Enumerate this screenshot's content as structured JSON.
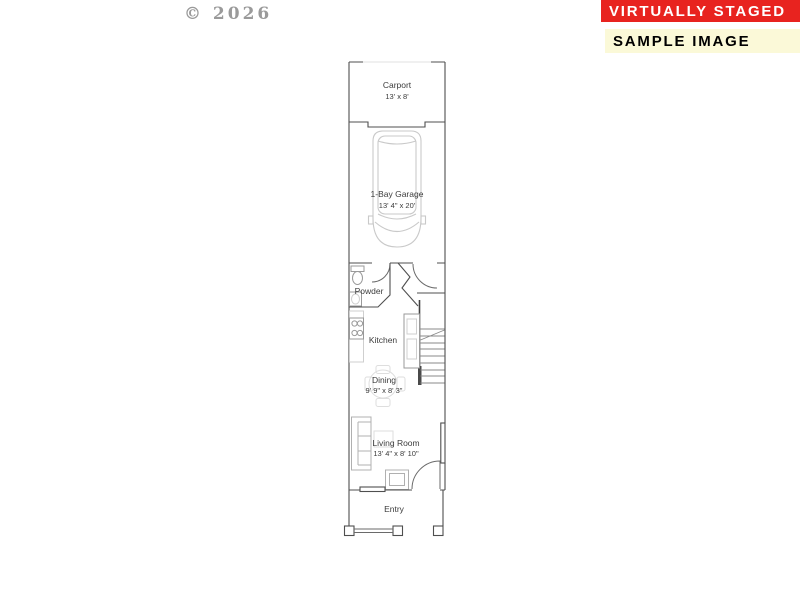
{
  "copyright": "© 2026",
  "badges": {
    "virtually_staged": {
      "label": "VIRTUALLY STAGED",
      "bg": "#e8231f",
      "fg": "#ffffff"
    },
    "sample_image": {
      "label": "SAMPLE IMAGE",
      "bg": "#fbf9d8",
      "fg": "#000000"
    }
  },
  "floor_plan": {
    "type": "single-level townhome floor plan",
    "rooms": [
      {
        "id": "carport",
        "label": "Carport",
        "dims": "13' x 8'"
      },
      {
        "id": "garage",
        "label": "1-Bay Garage",
        "dims": "13' 4\" x 20'"
      },
      {
        "id": "powder",
        "label": "Powder",
        "dims": ""
      },
      {
        "id": "kitchen",
        "label": "Kitchen",
        "dims": ""
      },
      {
        "id": "dining",
        "label": "Dining",
        "dims": "9' 9\" x 8' 3\""
      },
      {
        "id": "living_room",
        "label": "Living Room",
        "dims": "13' 4\" x 8' 10\""
      },
      {
        "id": "entry",
        "label": "Entry",
        "dims": ""
      }
    ],
    "features": [
      "staircase",
      "car-outline-in-garage",
      "front-porch-posts",
      "porch-railing"
    ],
    "colors": {
      "wall": "#4f4f4f",
      "furniture": "#b0b0b0",
      "faint": "#dedede"
    }
  }
}
